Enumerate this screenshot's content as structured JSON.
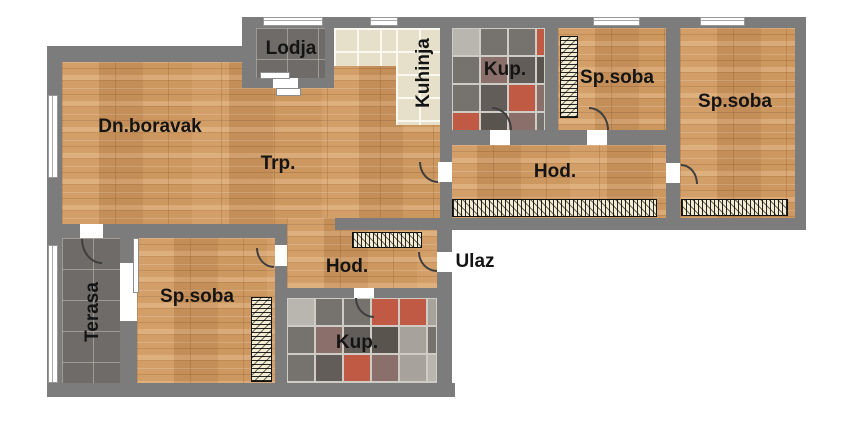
{
  "plan": {
    "rooms": {
      "living": {
        "label": "Dn.boravak"
      },
      "dining": {
        "label": "Trp."
      },
      "loggia": {
        "label": "Lodja"
      },
      "kitchen": {
        "label": "Kuhinja"
      },
      "bath_top": {
        "label": "Kup."
      },
      "bedroom_top": {
        "label": "Sp.soba"
      },
      "bedroom_right": {
        "label": "Sp.soba"
      },
      "hall_top": {
        "label": "Hod."
      },
      "terrace": {
        "label": "Terasa"
      },
      "bedroom_bottom": {
        "label": "Sp.soba"
      },
      "hall_bottom": {
        "label": "Hod."
      },
      "bath_bottom": {
        "label": "Kup."
      },
      "entrance": {
        "label": "Ulaz"
      }
    },
    "colors": {
      "wall": "#7c7c7c",
      "wood": "#cd9760",
      "tile_dark": "#6e6b68",
      "tile_beige": "#e6e0cb",
      "wardrobe": "#f1ecd2",
      "label_text": "#141414",
      "mosaic_grout": "#cfccc5",
      "mosaic_palette": [
        "#5a544f",
        "#a7a39c",
        "#c05a44",
        "#76726e",
        "#b9b6af",
        "#8b6f6b",
        "#635d5a",
        "#9a968f"
      ]
    }
  }
}
